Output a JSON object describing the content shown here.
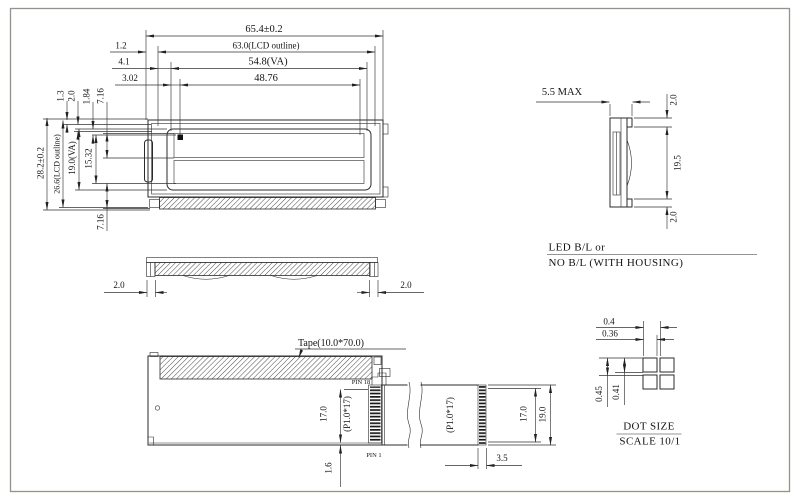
{
  "colors": {
    "background": "#ffffff",
    "line": "#2b2b2b",
    "text": "#141414",
    "page_border": "#93938a"
  },
  "drawing": {
    "front_view": {
      "dim_overall_width": "65.4±0.2",
      "dim_lcd_outline_width": "63.0(LCD outline)",
      "dim_va_width": "54.8(VA)",
      "dim_active_width": "48.76",
      "dim_offset_left_1": "1.2",
      "dim_offset_left_2": "4.1",
      "dim_offset_left_3": "3.02",
      "dim_top_gap_1": "1.3",
      "dim_top_gap_2": "2.0",
      "dim_top_gap_3": "1.84",
      "dim_row_height_top": "7.16",
      "dim_row_height_bottom": "7.16",
      "dim_overall_height": "28.2±0.2",
      "dim_lcd_outline_height": "26.6(LCD outline)",
      "dim_va_height": "19.0(VA)",
      "dim_active_height": "15.32"
    },
    "side_view": {
      "dim_thickness_max": "5.5 MAX",
      "dim_top_tab": "2.0",
      "dim_housing_height": "19.5",
      "dim_bottom_tab": "2.0",
      "caption_line1": "LED B/L or",
      "caption_line2": "NO B/L (WITH HOUSING)"
    },
    "profile_view": {
      "dim_tab_left": "2.0",
      "dim_tab_right": "2.0"
    },
    "bottom_view": {
      "tape_label": "Tape(10.0*70.0)",
      "pin18_label": "PIN 18",
      "pin1_label": "PIN 1",
      "dim_pin_span_left": "17.0",
      "pin_pitch_left": "(P1.0*17)",
      "dim_bottom_gap": "1.6",
      "pin_pitch_cable": "(P1.0*17)",
      "dim_pin_span_right": "17.0",
      "dim_cable_width": "19.0",
      "dim_connector_offset": "3.5"
    },
    "dot_detail": {
      "dim_dot_pitch_x": "0.4",
      "dim_dot_width": "0.36",
      "dim_dot_pitch_y": "0.45",
      "dim_dot_height": "0.41",
      "title": "DOT SIZE",
      "scale_label": "SCALE 10/1"
    }
  }
}
